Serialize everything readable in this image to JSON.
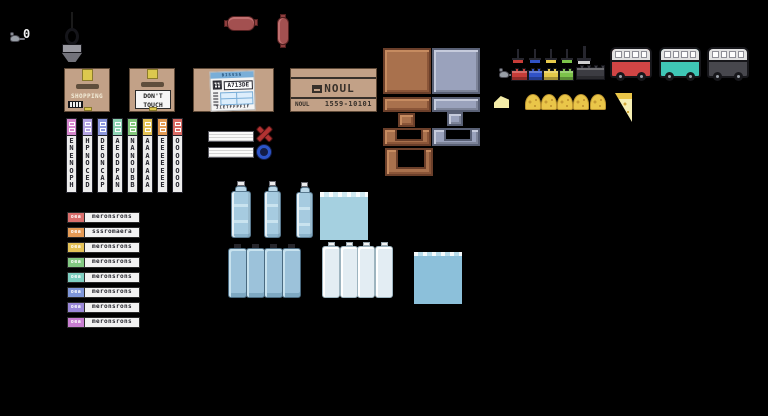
{
  "scene": {
    "background": "#000000",
    "description": "pixel-art game sprite sheet"
  },
  "hud": {
    "counter_value": "0"
  },
  "boxes": {
    "shopping": {
      "label": "SHOPPING"
    },
    "dont_touch": {
      "line1": "DON'T",
      "line2": "TOUCH"
    },
    "shipping": {
      "header_text": "BISVSG",
      "code": "A713DE",
      "footer_text": "3IETFFPFIF"
    },
    "noul": {
      "logo": "NOUL",
      "brand": "NOUL",
      "serial": "1559-10101"
    }
  },
  "spray_cans": [
    {
      "cap_color": "#d687cd",
      "text": "ENENOPH"
    },
    {
      "cap_color": "#b3a3e2",
      "text": "HPNOCED"
    },
    {
      "cap_color": "#8b97dd",
      "text": "DEONCAP"
    },
    {
      "cap_color": "#8dd3b3",
      "text": "AEODPAN"
    },
    {
      "cap_color": "#83c77b",
      "text": "NANOUBB"
    },
    {
      "cap_color": "#e4c254",
      "text": "AAAAAAA"
    },
    {
      "cap_color": "#e29a52",
      "text": "EEEEEEE"
    },
    {
      "cap_color": "#d96a63",
      "text": "OOOOOOO"
    }
  ],
  "name_labels": [
    {
      "tab_color": "#d96e6c",
      "tab_text": "oea",
      "text": "meronsrons"
    },
    {
      "tab_color": "#e49a55",
      "tab_text": "oea",
      "text": "sssromaera"
    },
    {
      "tab_color": "#e4c257",
      "tab_text": "oea",
      "text": "meronsrons"
    },
    {
      "tab_color": "#82c882",
      "tab_text": "oea",
      "text": "meronsrons"
    },
    {
      "tab_color": "#7ecfc1",
      "tab_text": "oea",
      "text": "meronsrons"
    },
    {
      "tab_color": "#7e96d8",
      "tab_text": "oea",
      "text": "meronsrons"
    },
    {
      "tab_color": "#9a88d8",
      "tab_text": "oea",
      "text": "meronsrons"
    },
    {
      "tab_color": "#c87ed1",
      "tab_text": "oea",
      "text": "meronsrons"
    }
  ],
  "palette": {
    "box_tan": "#c2a187",
    "tape_yellow": "#dcc84e",
    "crate_brown": "#a9714d",
    "crate_silver": "#9aa2bc",
    "brick_colors": [
      "#c63c38",
      "#3052c6",
      "#e6c94a",
      "#7cc34a",
      "#3c3c42"
    ],
    "van_colors": [
      "#d04545",
      "#3fc6b6",
      "#47474d"
    ],
    "cheese_yellow": "#eac649",
    "water_blue": "#a5d0e0",
    "sausage_red": "#a35050",
    "mark_x_red": "#b23232",
    "mark_o_blue": "#2c54c8"
  }
}
